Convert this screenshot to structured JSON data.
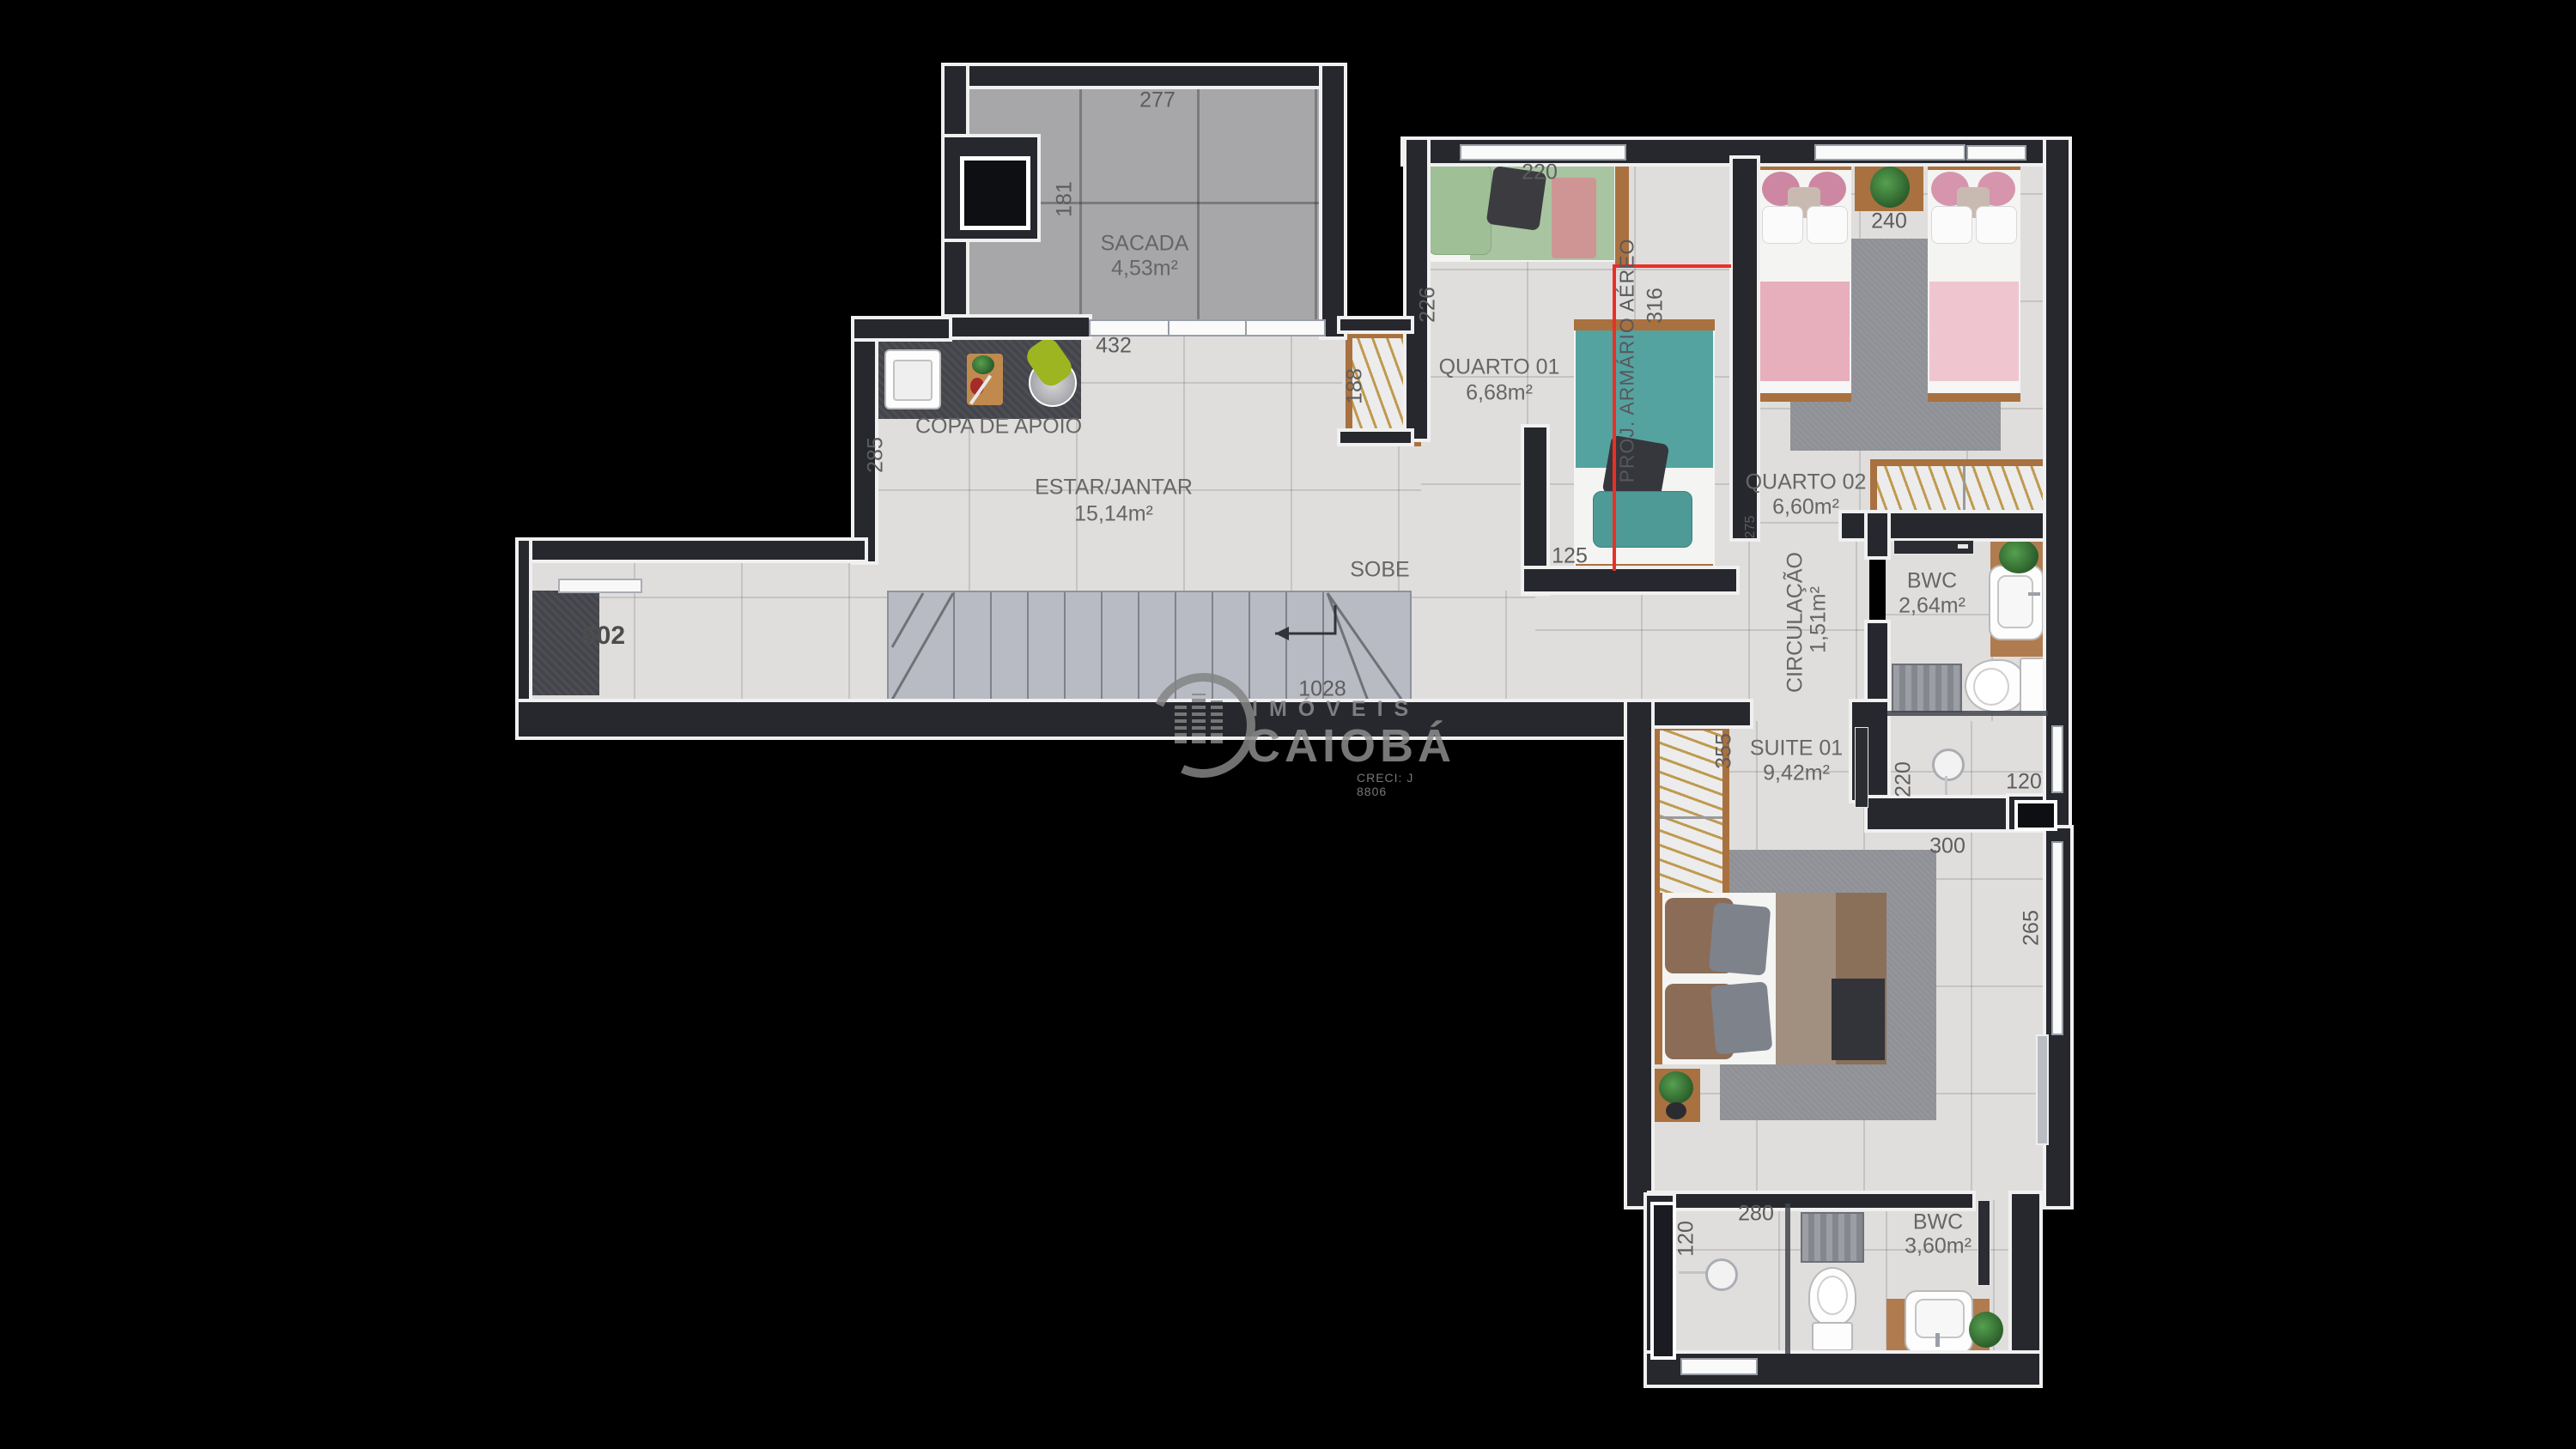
{
  "watermark": {
    "brand_top": "IMÓVEIS",
    "brand_main": "CAIOBÁ",
    "creci": "CRECI: J 8806"
  },
  "unit": {
    "number": "602"
  },
  "stairs": {
    "direction_label": "SOBE",
    "length": "1028"
  },
  "rooms": {
    "sacada": {
      "name": "SACADA",
      "area": "4,53m²"
    },
    "copa": {
      "name": "COPA DE APOIO"
    },
    "estar": {
      "name": "ESTAR/JANTAR",
      "area": "15,14m²"
    },
    "quarto1": {
      "name": "QUARTO 01",
      "area": "6,68m²"
    },
    "quarto2": {
      "name": "QUARTO 02",
      "area": "6,60m²"
    },
    "bwc1": {
      "name": "BWC",
      "area": "2,64m²"
    },
    "circulacao": {
      "name": "CIRCULAÇÃO",
      "area": "1,51m²"
    },
    "suite": {
      "name": "SUITE 01",
      "area": "9,42m²"
    },
    "bwc2": {
      "name": "BWC",
      "area": "3,60m²"
    }
  },
  "annotations": {
    "proj_armario": "PROJ. ARMÁRIO AÉREO"
  },
  "dimensions": {
    "sacada_width": "277",
    "sacada_depth": "181",
    "sacada_door": "432",
    "copa_depth": "285",
    "quarto1_bed": "220",
    "quarto1_depth": "226",
    "armario_depth": "316",
    "closet_width": "188",
    "quarto1_recess": "125",
    "quarto2_beds": "240",
    "quarto2_door": "275",
    "suite_closet": "355",
    "suite_width": "300",
    "suite_depth": "265",
    "bwc1_shower_depth": "220",
    "bwc1_shower_width": "120",
    "bwc2_width": "280",
    "bwc2_shower_width": "120"
  },
  "colors": {
    "background": "#000000",
    "wall": "#26282e",
    "wall_outline": "#f0f0f0",
    "floor": "#e0dedc",
    "balcony_floor": "#a7a7aa",
    "annotation_red": "#ea2f27",
    "label_text": "#666666",
    "watermark_grey": "#8c8c8c"
  }
}
